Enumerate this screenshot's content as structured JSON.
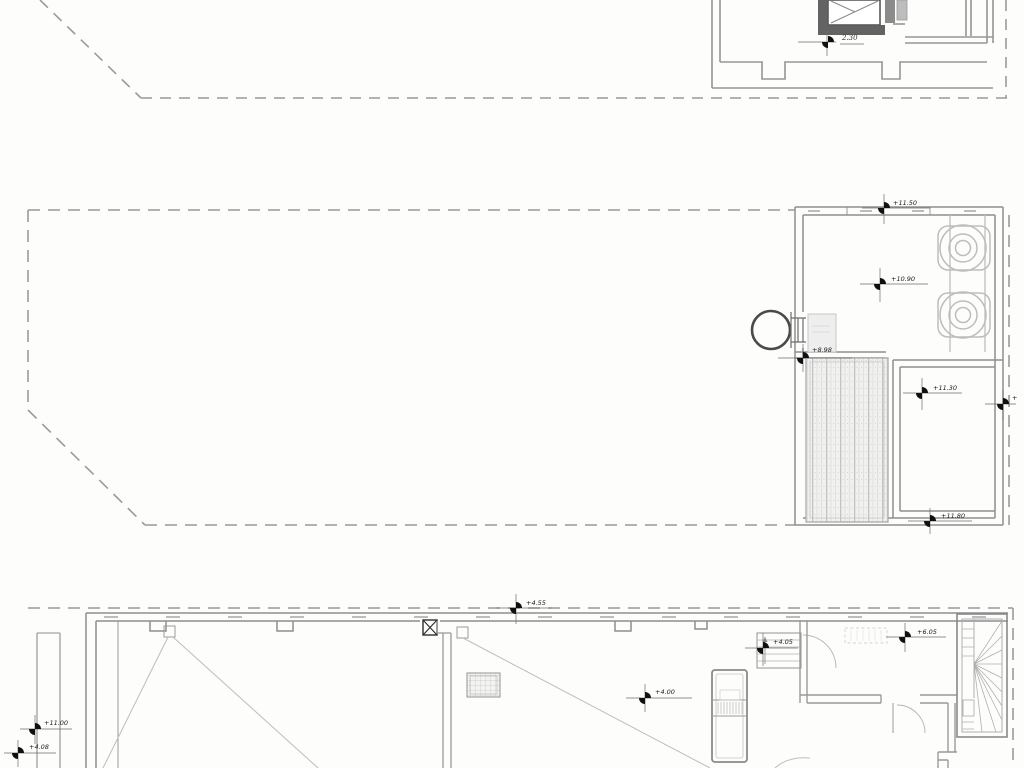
{
  "app": {
    "type": "cad-roof-plan-drawing",
    "background_color": "#fdfdfc",
    "wall_color": "#8f8f8f",
    "dash_color": "#9a9a9a",
    "marker_color": "#101010",
    "hatch_color": "#cfcfcf"
  },
  "drawing": {
    "description": "Architectural roof plans at three levels with dashed property/roof-outline boundaries, elevation level markers, roof vents, hatched deck, elevator shaft and winder stair"
  },
  "labels": {
    "upper_dim": "2.30",
    "mid_top": "+11.50",
    "mid_center": "+10.90",
    "mid_left": "+8.98",
    "mid_room": "+11.30",
    "mid_room_bottom": "+11.80",
    "mid_right_edge": "+",
    "low_top": "+4.55",
    "low_left_upper": "+11.00",
    "low_left_lower": "+4.08",
    "low_center": "+4.00",
    "low_landing": "+4.05",
    "low_upper_landing": "+6.05"
  }
}
